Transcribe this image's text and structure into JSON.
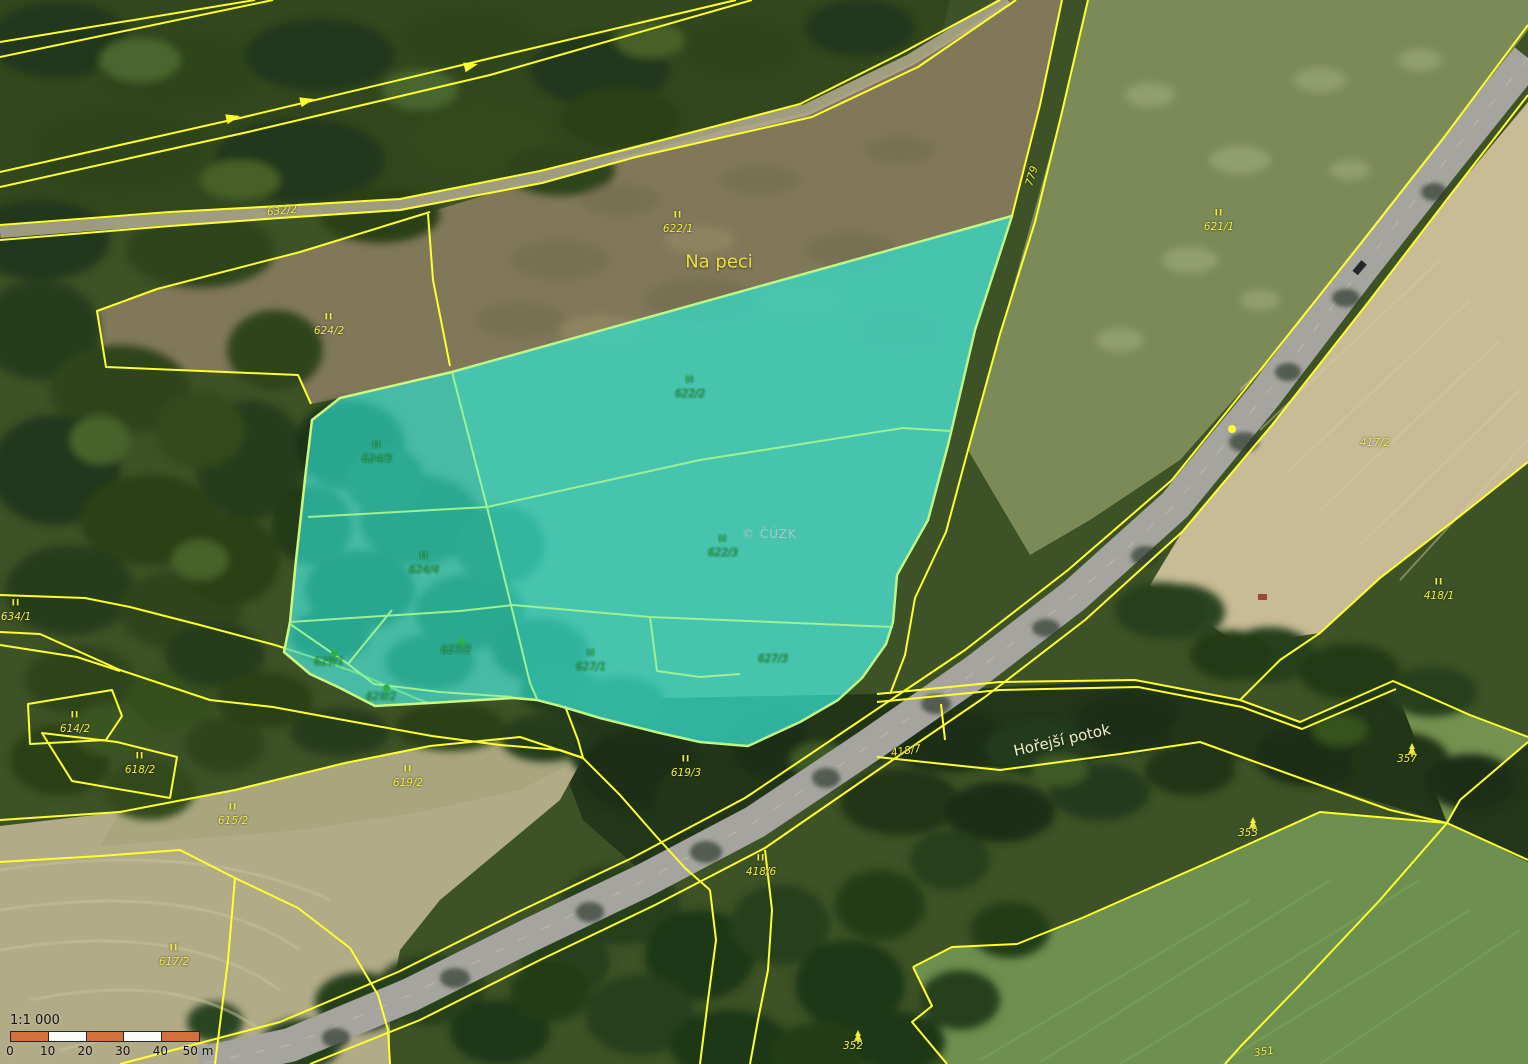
{
  "map": {
    "watermark": "© ČÚZK",
    "colors": {
      "parcel_label_yellow": "#f2ec3e",
      "parcel_label_green": "#2db245",
      "cadastre_line_yellow": "#ffff2f",
      "highlight_fill": "#2fd7c5",
      "highlight_edge": "#cdf87f",
      "highlight_inner_line": "#9cf193",
      "scalebar_orange": "#d2713b",
      "scalebar_white": "#fafaf8"
    },
    "place_labels": [
      {
        "text": "Na peci",
        "x": 719,
        "y": 262,
        "size": 18,
        "color": "#ecdf3e",
        "r": 0
      },
      {
        "text": "Hořejší potok",
        "x": 1062,
        "y": 740,
        "size": 15,
        "color": "#efecca",
        "r": -13
      }
    ],
    "parcel_labels": [
      {
        "text": "632/2",
        "x": 282,
        "y": 211,
        "c": "y",
        "sym": null,
        "r": -6
      },
      {
        "text": "622/1",
        "x": 678,
        "y": 229,
        "c": "y",
        "sym": "grass",
        "r": 0
      },
      {
        "text": "624/2",
        "x": 329,
        "y": 331,
        "c": "y",
        "sym": "grass",
        "r": 0
      },
      {
        "text": "779",
        "x": 1032,
        "y": 176,
        "c": "y",
        "sym": null,
        "r": -73
      },
      {
        "text": "621/1",
        "x": 1219,
        "y": 227,
        "c": "y",
        "sym": "grass",
        "r": 0
      },
      {
        "text": "417/2",
        "x": 1375,
        "y": 443,
        "c": "y",
        "sym": null,
        "r": 0
      },
      {
        "text": "418/1",
        "x": 1439,
        "y": 596,
        "c": "y",
        "sym": "grass",
        "r": 0
      },
      {
        "text": "418/7",
        "x": 906,
        "y": 751,
        "c": "y",
        "sym": null,
        "r": -9
      },
      {
        "text": "418/6",
        "x": 761,
        "y": 872,
        "c": "y",
        "sym": "grass",
        "r": 0
      },
      {
        "text": "634/1",
        "x": 16,
        "y": 617,
        "c": "y",
        "sym": "grass",
        "r": 0
      },
      {
        "text": "614/2",
        "x": 75,
        "y": 729,
        "c": "y",
        "sym": "grass",
        "r": 0
      },
      {
        "text": "618/2",
        "x": 140,
        "y": 770,
        "c": "y",
        "sym": "grass",
        "r": 0
      },
      {
        "text": "615/2",
        "x": 233,
        "y": 821,
        "c": "y",
        "sym": "grass",
        "r": 0
      },
      {
        "text": "619/2",
        "x": 408,
        "y": 783,
        "c": "y",
        "sym": "grass",
        "r": 0
      },
      {
        "text": "619/3",
        "x": 686,
        "y": 773,
        "c": "y",
        "sym": "grass",
        "r": 0
      },
      {
        "text": "617/2",
        "x": 174,
        "y": 962,
        "c": "y",
        "sym": "grass",
        "r": 0
      },
      {
        "text": "353",
        "x": 1248,
        "y": 833,
        "c": "y",
        "sym": "conifer",
        "r": 0
      },
      {
        "text": "357",
        "x": 1407,
        "y": 759,
        "c": "y",
        "sym": "conifer",
        "r": 0
      },
      {
        "text": "352",
        "x": 853,
        "y": 1046,
        "c": "y",
        "sym": "conifer",
        "r": 0
      },
      {
        "text": "351",
        "x": 1264,
        "y": 1052,
        "c": "y",
        "sym": null,
        "r": -8
      },
      {
        "text": "622/2",
        "x": 690,
        "y": 394,
        "c": "g",
        "sym": "grass",
        "r": 0
      },
      {
        "text": "622/3",
        "x": 723,
        "y": 553,
        "c": "g",
        "sym": "grass",
        "r": 0
      },
      {
        "text": "624/3",
        "x": 377,
        "y": 459,
        "c": "g",
        "sym": "grass",
        "r": 0
      },
      {
        "text": "624/4",
        "x": 424,
        "y": 570,
        "c": "g",
        "sym": "grass",
        "r": 0
      },
      {
        "text": "627/1",
        "x": 591,
        "y": 667,
        "c": "g",
        "sym": "grass",
        "r": 0
      },
      {
        "text": "627/2",
        "x": 456,
        "y": 650,
        "c": "g",
        "sym": "tree",
        "r": 0
      },
      {
        "text": "627/3",
        "x": 773,
        "y": 659,
        "c": "g",
        "sym": null,
        "r": 0
      },
      {
        "text": "629/1",
        "x": 329,
        "y": 662,
        "c": "g",
        "sym": "tree",
        "r": 0
      },
      {
        "text": "629/2",
        "x": 381,
        "y": 697,
        "c": "g",
        "sym": "tree",
        "r": 0
      }
    ],
    "scalebar": {
      "ratio": "1:1 000",
      "segments": [
        "#d2713b",
        "#fafaf8",
        "#d2713b",
        "#fafaf8",
        "#d2713b"
      ],
      "ticks": [
        "0",
        "10",
        "20",
        "30",
        "40",
        "50 m"
      ]
    }
  }
}
